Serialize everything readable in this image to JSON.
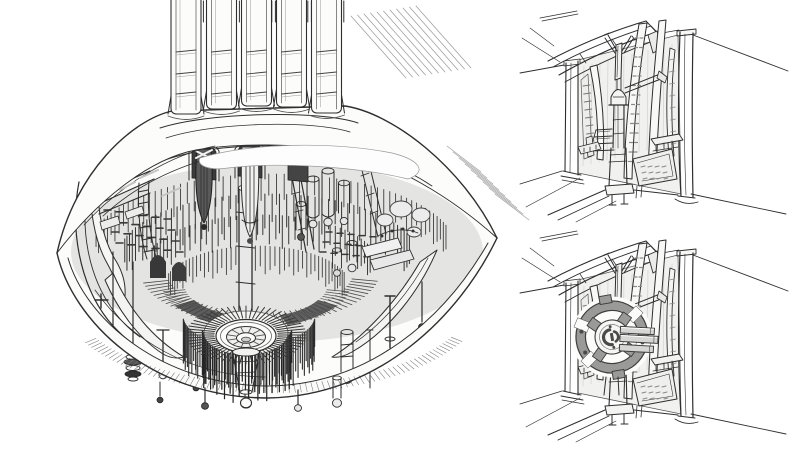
{
  "page": {
    "title": "Pencil concept sketch sheet",
    "background": "#ffffff"
  },
  "panels": {
    "machine": {
      "name": "engine-core-sketch",
      "description": "Large saucer-shaped machine: ribbed column rising from a shallow dome, dense mechanical underside with hanging pods, pistons and slatted rings around a concentric circular hub with a dropped funnel and ball-tipped rods"
    },
    "alcove_top": {
      "name": "wall-alcove-sketch",
      "description": "Ornate interior wall niche between two slender columns with curved ribs, a dagger-shaped pylon over a stepped plinth, receding walls and perspective floor lines"
    },
    "alcove_bottom": {
      "name": "wall-alcove-emblem-sketch",
      "description": "Same wall niche with a large segmented ring emblem wheel mounted at center and three horizontal bars extending right"
    }
  },
  "palette": {
    "paper": "#ffffff",
    "pencil_dark": "#2e2e2e",
    "pencil_mid": "#555555",
    "pencil_light": "#9a9a9a",
    "shade_fill": "#9a9a98"
  }
}
